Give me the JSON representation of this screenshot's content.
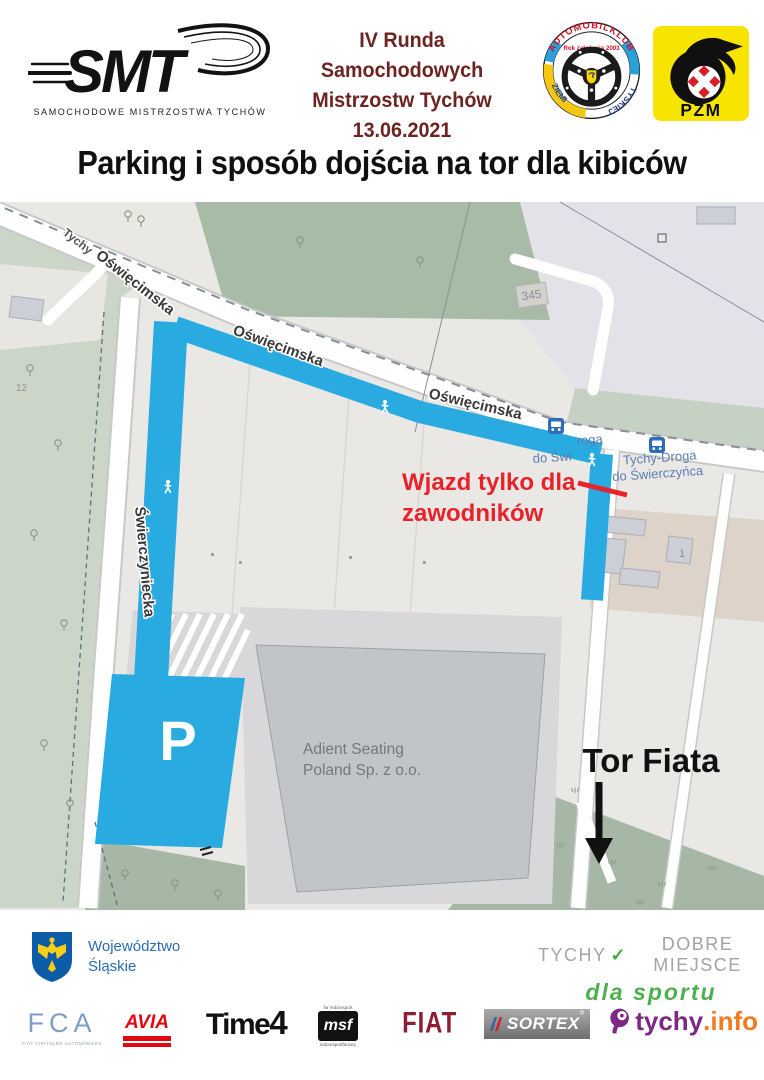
{
  "header": {
    "smt": {
      "text": "SMT",
      "tagline": "SAMOCHODOWE MISTRZOSTWA TYCHÓW"
    },
    "event": {
      "line1": "IV Runda Samochodowych",
      "line2": "Mistrzostw Tychów",
      "date": "13.06.2021",
      "color": "#6d2420"
    },
    "club": {
      "arc": "AUTOMOBILKLUB",
      "founded": "Rok założenia 2003",
      "left": "ZIEMI",
      "right": "TYSKIEJ"
    },
    "pzm": {
      "text": "PZM"
    }
  },
  "title": "Parking i sposób dojścia na tor dla kibiców",
  "map": {
    "streets": {
      "tychy": "Tychy",
      "oswiecimska1": "Oświęcimska",
      "oswiecimska2": "Oświęcimska",
      "oswiecimska3": "Oświęcimska",
      "swierczyniecka": "Świerczyniecka"
    },
    "labels": {
      "b345": "345",
      "b12": "12",
      "b1": "1",
      "adient1": "Adient Seating",
      "adient2": "Poland Sp. z o.o.",
      "bus1": "Tychy-Droga",
      "bus2": "do Świerczyńca",
      "frag1": "roga",
      "frag2": "do Świ",
      "parking": "P",
      "entry1": "Wjazd tylko dla",
      "entry2": "zawodników",
      "tor": "Tor Fiata"
    },
    "colors": {
      "route_blue": "#29abe2",
      "entry_red": "#e8212a",
      "bus_blue": "#2f6db8",
      "bus_label": "#5b7db1"
    }
  },
  "footer": {
    "voivodeship": {
      "line1": "Województwo",
      "line2": "Śląskie"
    },
    "claim": {
      "part1": "TYCHY",
      "check": "✓",
      "part2": "DOBRE MIEJSCE",
      "sub": "dla sportu"
    },
    "sponsors": {
      "fca": {
        "text": "FCA",
        "sub": "FIAT CHRYSLER AUTOMOBILES"
      },
      "avia": {
        "text": "AVIA"
      },
      "time4": {
        "name": "Time",
        "four": "4"
      },
      "msf": {
        "top": "for indoorsport",
        "text": "msf",
        "sub": "indoorsportfactory"
      },
      "fiat": {
        "text": "FIAT"
      },
      "sortex": {
        "text": "SORTEX",
        "r": "®"
      },
      "tychyinfo": {
        "name": "tychy",
        "tld": ".info"
      }
    }
  }
}
